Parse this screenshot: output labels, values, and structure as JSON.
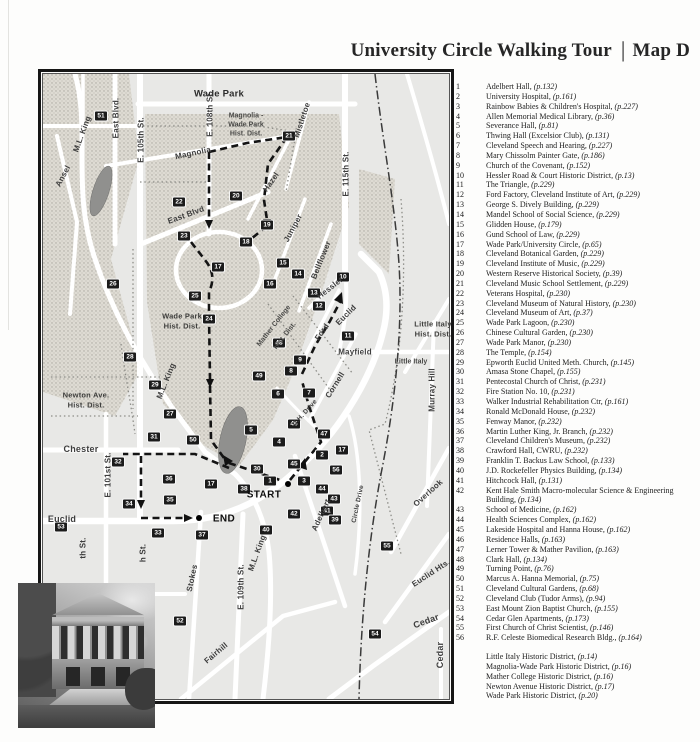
{
  "page": {
    "title_main": "University Circle Walking Tour",
    "title_separator": "|",
    "title_map": "Map D"
  },
  "legend": {
    "items": [
      {
        "n": "1",
        "name": "Adelbert Hall",
        "page": "p.132"
      },
      {
        "n": "2",
        "name": "University Hospital",
        "page": "p.161"
      },
      {
        "n": "3",
        "name": "Rainbow Babies & Children's Hospital",
        "page": "p.227"
      },
      {
        "n": "4",
        "name": "Allen Memorial Medical Library",
        "page": "p.36"
      },
      {
        "n": "5",
        "name": "Severance Hall",
        "page": "p.81"
      },
      {
        "n": "6",
        "name": "Thwing Hall (Excelsior Club)",
        "page": "p.131"
      },
      {
        "n": "7",
        "name": "Cleveland Speech and Hearing",
        "page": "p.227"
      },
      {
        "n": "8",
        "name": "Mary Chissolm Painter Gate",
        "page": "p.186"
      },
      {
        "n": "9",
        "name": "Church of the Covenant",
        "page": "p.152"
      },
      {
        "n": "10",
        "name": "Hessler Road & Court Historic District",
        "page": "p.13"
      },
      {
        "n": "11",
        "name": "The Triangle",
        "page": "p.229"
      },
      {
        "n": "12",
        "name": "Ford Factory, Cleveland Institute of Art",
        "page": "p.229"
      },
      {
        "n": "13",
        "name": "George S. Dively Building",
        "page": "p.229"
      },
      {
        "n": "14",
        "name": "Mandel School of Social Science",
        "page": "p.229"
      },
      {
        "n": "15",
        "name": "Glidden House",
        "page": "p.179"
      },
      {
        "n": "16",
        "name": "Gund School of Law",
        "page": "p.229"
      },
      {
        "n": "17",
        "name": "Wade Park/University Circle",
        "page": "p.65"
      },
      {
        "n": "18",
        "name": "Cleveland Botanical Garden",
        "page": "p.229"
      },
      {
        "n": "19",
        "name": "Cleveland Institute of Music",
        "page": "p.229"
      },
      {
        "n": "20",
        "name": "Western Reserve Historical Society",
        "page": "p.39"
      },
      {
        "n": "21",
        "name": "Cleveland Music School Settlement",
        "page": "p.229"
      },
      {
        "n": "22",
        "name": "Veterans Hospital",
        "page": "p.230"
      },
      {
        "n": "23",
        "name": "Cleveland Museum of Natural History",
        "page": "p.230"
      },
      {
        "n": "24",
        "name": "Cleveland Museum of Art",
        "page": "p.37"
      },
      {
        "n": "25",
        "name": "Wade Park Lagoon",
        "page": "p.230"
      },
      {
        "n": "26",
        "name": "Chinese Cultural Garden",
        "page": "p.230"
      },
      {
        "n": "27",
        "name": "Wade Park Manor",
        "page": "p.230"
      },
      {
        "n": "28",
        "name": "The Temple",
        "page": "p.154"
      },
      {
        "n": "29",
        "name": "Epworth Euclid United Meth. Church",
        "page": "p.145"
      },
      {
        "n": "30",
        "name": "Amasa Stone Chapel",
        "page": "p.155"
      },
      {
        "n": "31",
        "name": "Pentecostal Church of Christ",
        "page": "p.231"
      },
      {
        "n": "32",
        "name": "Fire Station No. 10",
        "page": "p.231"
      },
      {
        "n": "33",
        "name": "Walker Industrial Rehabilitation Ctr",
        "page": "p.161"
      },
      {
        "n": "34",
        "name": "Ronald McDonald House",
        "page": "p.232"
      },
      {
        "n": "35",
        "name": "Fenway Manor",
        "page": "p.232"
      },
      {
        "n": "36",
        "name": "Martin Luther King, Jr. Branch",
        "page": "p.232"
      },
      {
        "n": "37",
        "name": "Cleveland Children's Museum",
        "page": "p.232"
      },
      {
        "n": "38",
        "name": "Crawford Hall, CWRU",
        "page": "p.232"
      },
      {
        "n": "39",
        "name": "Franklin T. Backus Law School",
        "page": "p.133"
      },
      {
        "n": "40",
        "name": "J.D. Rockefeller Physics Building",
        "page": "p.134"
      },
      {
        "n": "41",
        "name": "Hitchcock Hall",
        "page": "p.131"
      },
      {
        "n": "42",
        "name": "Kent Hale Smith Macro-molecular Science & Engineering Building",
        "page": "p.134"
      },
      {
        "n": "43",
        "name": "School of Medicine",
        "page": "p.162"
      },
      {
        "n": "44",
        "name": "Health Sciences Complex",
        "page": "p.162"
      },
      {
        "n": "45",
        "name": "Lakeside Hospital and Hanna House",
        "page": "p.162"
      },
      {
        "n": "46",
        "name": "Residence Halls",
        "page": "p.163"
      },
      {
        "n": "47",
        "name": "Lerner Tower & Mather Pavilion",
        "page": "p.163"
      },
      {
        "n": "48",
        "name": "Clark Hall",
        "page": "p.134"
      },
      {
        "n": "49",
        "name": "Turning Point",
        "page": "p.76"
      },
      {
        "n": "50",
        "name": "Marcus A. Hanna Memorial",
        "page": "p.75"
      },
      {
        "n": "51",
        "name": "Cleveland Cultural Gardens",
        "page": "p.68"
      },
      {
        "n": "52",
        "name": "Cleveland Club (Tudor Arms)",
        "page": "p.94"
      },
      {
        "n": "53",
        "name": "East Mount Zion Baptist Church",
        "page": "p.155"
      },
      {
        "n": "54",
        "name": "Cedar Glen Apartments",
        "page": "p.173"
      },
      {
        "n": "55",
        "name": "First Church of Christ Scientist",
        "page": "p.146"
      },
      {
        "n": "56",
        "name": "R.F. Celeste Biomedical Research Bldg.",
        "page": "p.164"
      }
    ],
    "districts": [
      {
        "name": "Little Italy Historic District",
        "page": "p.14"
      },
      {
        "name": "Magnolia-Wade Park Historic District",
        "page": "p.16"
      },
      {
        "name": "Mather College Historic District",
        "page": "p.16"
      },
      {
        "name": "Newton Avenue Historic District",
        "page": "p.17"
      },
      {
        "name": "Wade Park Historic District",
        "page": "p.20"
      }
    ]
  },
  "map": {
    "start_label": "START",
    "end_label": "END",
    "labels": [
      {
        "t": "Wade Park",
        "x": 176,
        "y": 20,
        "r": 0,
        "k": "big"
      },
      {
        "t": "Magnolia -",
        "x": 203,
        "y": 42,
        "r": 0,
        "k": "dist"
      },
      {
        "t": "Wade Park",
        "x": 203,
        "y": 51,
        "r": 0,
        "k": "dist"
      },
      {
        "t": "Hist. Dist.",
        "x": 203,
        "y": 60,
        "r": 0,
        "k": "dist"
      },
      {
        "t": "Magnolia",
        "x": 150,
        "y": 79,
        "r": -12
      },
      {
        "t": "Mistletoe",
        "x": 259,
        "y": 46,
        "r": -72
      },
      {
        "t": "Hazel",
        "x": 228,
        "y": 108,
        "r": -55
      },
      {
        "t": "E. 115th St.",
        "x": 303,
        "y": 100,
        "r": -90
      },
      {
        "t": "E. 108th St.",
        "x": 167,
        "y": 40,
        "r": -90
      },
      {
        "t": "E. 105th St.",
        "x": 98,
        "y": 66,
        "r": -90
      },
      {
        "t": "East Blvd.",
        "x": 73,
        "y": 44,
        "r": -90
      },
      {
        "t": "M.L. King",
        "x": 39,
        "y": 60,
        "r": -70
      },
      {
        "t": "Ansel",
        "x": 20,
        "y": 102,
        "r": -62
      },
      {
        "t": "East Blvd",
        "x": 143,
        "y": 141,
        "r": -20
      },
      {
        "t": "Juniper",
        "x": 250,
        "y": 154,
        "r": -62
      },
      {
        "t": "Bellflower",
        "x": 278,
        "y": 186,
        "r": -68
      },
      {
        "t": "Hessler",
        "x": 287,
        "y": 214,
        "r": -38
      },
      {
        "t": "Ford",
        "x": 279,
        "y": 258,
        "r": -55
      },
      {
        "t": "Euclid",
        "x": 303,
        "y": 241,
        "r": -45
      },
      {
        "t": "Mayfield",
        "x": 312,
        "y": 278,
        "r": 0
      },
      {
        "t": "Cornell",
        "x": 292,
        "y": 311,
        "r": -58
      },
      {
        "t": "Little Italy",
        "x": 390,
        "y": 250,
        "r": 0,
        "k": "dist2"
      },
      {
        "t": "Hist. Dist.",
        "x": 390,
        "y": 260,
        "r": 0,
        "k": "dist2"
      },
      {
        "t": "Murray Hill",
        "x": 389,
        "y": 316,
        "r": -90
      },
      {
        "t": "Wade Park",
        "x": 139,
        "y": 242,
        "r": 0,
        "k": "dist2"
      },
      {
        "t": "Hist. Dist.",
        "x": 139,
        "y": 252,
        "r": 0,
        "k": "dist2"
      },
      {
        "t": "Mather College",
        "x": 231,
        "y": 252,
        "r": -52,
        "k": "dist"
      },
      {
        "t": "Hist. Dist.",
        "x": 242,
        "y": 262,
        "r": -52,
        "k": "dist"
      },
      {
        "t": "M.L. King",
        "x": 123,
        "y": 307,
        "r": -68
      },
      {
        "t": "Newton Ave.",
        "x": 43,
        "y": 321,
        "r": 0,
        "k": "dist2"
      },
      {
        "t": "Hist. Dist.",
        "x": 43,
        "y": 331,
        "r": 0,
        "k": "dist2"
      },
      {
        "t": "Chester",
        "x": 38,
        "y": 375,
        "r": 0,
        "k": "strbig"
      },
      {
        "t": "E. 101st St.",
        "x": 65,
        "y": 401,
        "r": -90
      },
      {
        "t": "Euclid",
        "x": 19,
        "y": 445,
        "r": 0,
        "k": "strbig"
      },
      {
        "t": "th St.",
        "x": 40,
        "y": 474,
        "r": -90
      },
      {
        "t": "h St.",
        "x": 100,
        "y": 479,
        "r": -90
      },
      {
        "t": "Adelbert",
        "x": 278,
        "y": 441,
        "r": -65
      },
      {
        "t": "M.L. King",
        "x": 214,
        "y": 479,
        "r": -70
      },
      {
        "t": "U.H. Drive",
        "x": 262,
        "y": 339,
        "r": -48,
        "k": "tiny"
      },
      {
        "t": "Circle Drive",
        "x": 315,
        "y": 430,
        "r": -78,
        "k": "tiny"
      },
      {
        "t": "Little Italy",
        "x": 368,
        "y": 288,
        "r": 0,
        "k": "dist"
      },
      {
        "t": "Overlook",
        "x": 385,
        "y": 419,
        "r": -42
      },
      {
        "t": "Euclid Hts.",
        "x": 388,
        "y": 499,
        "r": -33
      },
      {
        "t": "Cedar",
        "x": 383,
        "y": 547,
        "r": -20,
        "k": "strbig"
      },
      {
        "t": "Cedar",
        "x": 397,
        "y": 581,
        "r": -90,
        "k": "strbig"
      },
      {
        "t": "Stokes",
        "x": 149,
        "y": 504,
        "r": -78
      },
      {
        "t": "E. 109th St.",
        "x": 198,
        "y": 513,
        "r": -90
      },
      {
        "t": "Fairhill",
        "x": 173,
        "y": 579,
        "r": -40
      }
    ],
    "markers": [
      {
        "n": "51",
        "x": 58,
        "y": 42
      },
      {
        "n": "22",
        "x": 136,
        "y": 128
      },
      {
        "n": "20",
        "x": 193,
        "y": 122
      },
      {
        "n": "21",
        "x": 246,
        "y": 62
      },
      {
        "n": "23",
        "x": 141,
        "y": 162
      },
      {
        "n": "19",
        "x": 224,
        "y": 151
      },
      {
        "n": "18",
        "x": 203,
        "y": 168
      },
      {
        "n": "17",
        "x": 175,
        "y": 193
      },
      {
        "n": "15",
        "x": 240,
        "y": 189
      },
      {
        "n": "14",
        "x": 255,
        "y": 200
      },
      {
        "n": "16",
        "x": 227,
        "y": 210
      },
      {
        "n": "13",
        "x": 271,
        "y": 219
      },
      {
        "n": "12",
        "x": 276,
        "y": 232
      },
      {
        "n": "10",
        "x": 300,
        "y": 203
      },
      {
        "n": "11",
        "x": 305,
        "y": 262
      },
      {
        "n": "24",
        "x": 166,
        "y": 245
      },
      {
        "n": "25",
        "x": 152,
        "y": 222
      },
      {
        "n": "26",
        "x": 70,
        "y": 210
      },
      {
        "n": "28",
        "x": 87,
        "y": 283
      },
      {
        "n": "29",
        "x": 112,
        "y": 311
      },
      {
        "n": "48",
        "x": 236,
        "y": 269
      },
      {
        "n": "9",
        "x": 257,
        "y": 286
      },
      {
        "n": "8",
        "x": 248,
        "y": 297
      },
      {
        "n": "49",
        "x": 216,
        "y": 302
      },
      {
        "n": "7",
        "x": 266,
        "y": 319
      },
      {
        "n": "6",
        "x": 235,
        "y": 320
      },
      {
        "n": "27",
        "x": 127,
        "y": 340
      },
      {
        "n": "31",
        "x": 111,
        "y": 363
      },
      {
        "n": "50",
        "x": 150,
        "y": 366
      },
      {
        "n": "5",
        "x": 208,
        "y": 356
      },
      {
        "n": "46",
        "x": 251,
        "y": 350
      },
      {
        "n": "47",
        "x": 281,
        "y": 360
      },
      {
        "n": "4",
        "x": 236,
        "y": 368
      },
      {
        "n": "2",
        "x": 279,
        "y": 381
      },
      {
        "n": "45",
        "x": 251,
        "y": 390
      },
      {
        "n": "30",
        "x": 214,
        "y": 395
      },
      {
        "n": "1",
        "x": 227,
        "y": 407
      },
      {
        "n": "3",
        "x": 261,
        "y": 407
      },
      {
        "n": "44",
        "x": 279,
        "y": 415
      },
      {
        "n": "38",
        "x": 201,
        "y": 415
      },
      {
        "n": "17",
        "x": 168,
        "y": 410
      },
      {
        "n": "42",
        "x": 251,
        "y": 440
      },
      {
        "n": "40",
        "x": 223,
        "y": 456
      },
      {
        "n": "32",
        "x": 75,
        "y": 388
      },
      {
        "n": "34",
        "x": 86,
        "y": 430
      },
      {
        "n": "36",
        "x": 126,
        "y": 405
      },
      {
        "n": "35",
        "x": 127,
        "y": 426
      },
      {
        "n": "33",
        "x": 115,
        "y": 459
      },
      {
        "n": "37",
        "x": 159,
        "y": 461
      },
      {
        "n": "53",
        "x": 18,
        "y": 453
      },
      {
        "n": "56",
        "x": 293,
        "y": 396
      },
      {
        "n": "17",
        "x": 299,
        "y": 376
      },
      {
        "n": "43",
        "x": 291,
        "y": 425
      },
      {
        "n": "41",
        "x": 284,
        "y": 437
      },
      {
        "n": "39",
        "x": 292,
        "y": 446
      },
      {
        "n": "55",
        "x": 344,
        "y": 472
      },
      {
        "n": "52",
        "x": 137,
        "y": 547
      },
      {
        "n": "54",
        "x": 332,
        "y": 560
      }
    ],
    "start": {
      "dot_x": 245,
      "dot_y": 410,
      "label_x": 221,
      "label_y": 421
    },
    "end": {
      "dot_x": 156,
      "dot_y": 444,
      "label_x": 181,
      "label_y": 445
    }
  }
}
